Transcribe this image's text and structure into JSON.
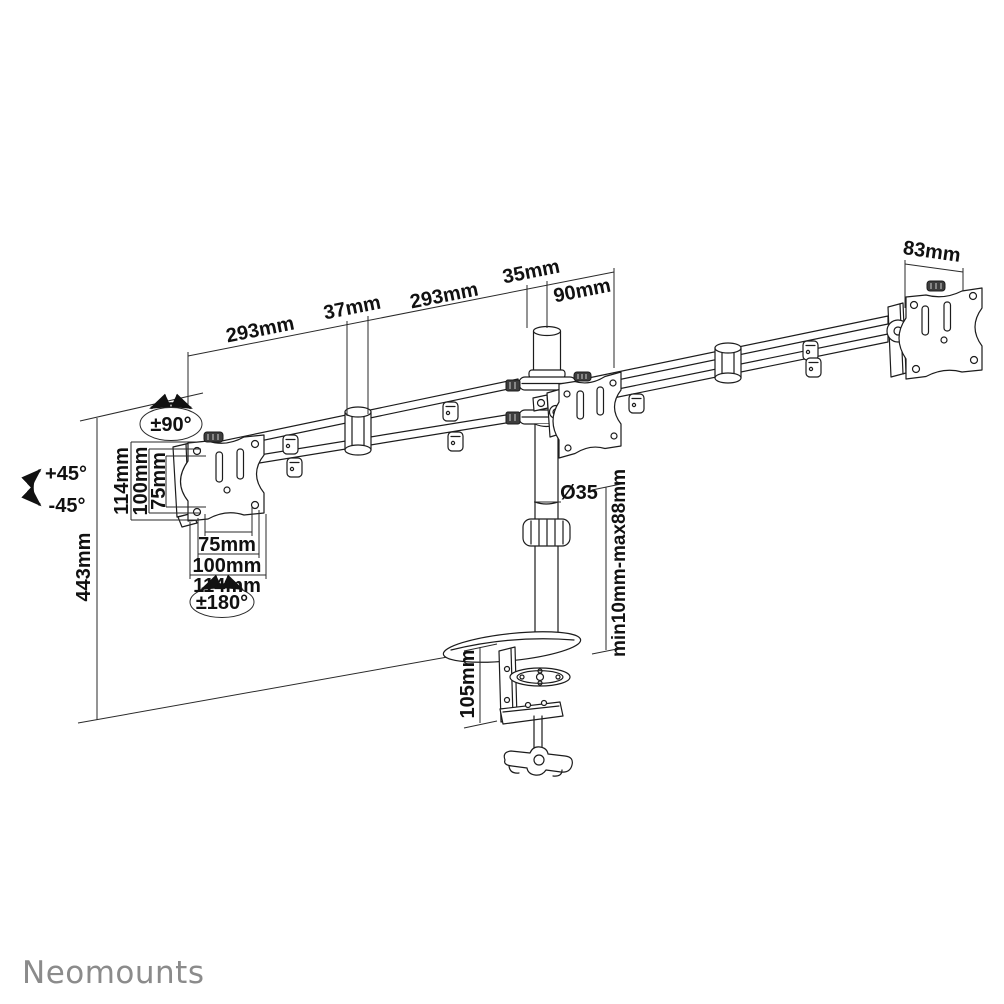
{
  "brand": {
    "logo": "Neomounts"
  },
  "labels": {
    "arm_left_length": "293mm",
    "connector_width": "37mm",
    "arm_right_length": "293mm",
    "pole_top_width": "35mm",
    "pole_offset": "90mm",
    "right_plate_width": "83mm",
    "swivel_range": "±90°",
    "tilt_up": "+45°",
    "tilt_down": "-45°",
    "vesa_vertical_114": "114mm",
    "vesa_vertical_100": "100mm",
    "vesa_vertical_75": "75mm",
    "vesa_horizontal_75": "75mm",
    "vesa_horizontal_100": "100mm",
    "vesa_horizontal_114": "114mm",
    "rotation_range": "±180°",
    "total_height": "443mm",
    "pole_diameter": "Ø35",
    "clamp_range": "min10mm-max88mm",
    "clamp_height": "105mm"
  }
}
